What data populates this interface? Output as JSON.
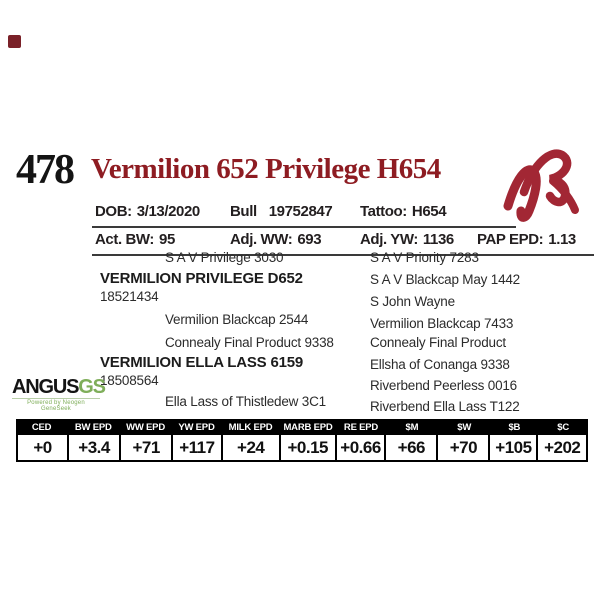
{
  "page": {
    "lot_number": "478",
    "title": "Vermilion 652 Privilege H654"
  },
  "info": {
    "row1": [
      {
        "label": "DOB:",
        "value": "3/13/2020"
      },
      {
        "label": "Bull",
        "value": "19752847"
      },
      {
        "label": "Tattoo:",
        "value": "H654"
      }
    ],
    "row2": [
      {
        "label": "Act. BW:",
        "value": "95"
      },
      {
        "label": "Adj. WW:",
        "value": "693"
      },
      {
        "label": "Adj. YW:",
        "value": "1136"
      },
      {
        "label": "PAP EPD:",
        "value": "1.13"
      }
    ]
  },
  "pedigree": {
    "left": [
      {
        "text": "S A V Privilege 3030"
      },
      {
        "text": "VERMILION PRIVILEGE D652"
      },
      {
        "text": "18521434"
      },
      {
        "text": "Vermilion Blackcap 2544"
      },
      {
        "text": "Connealy Final Product 9338"
      },
      {
        "text": "VERMILION ELLA LASS 6159"
      },
      {
        "text": "18508564"
      },
      {
        "text": "Ella Lass of Thistledew 3C1"
      }
    ],
    "right": [
      {
        "text": "S A V Priority 7283"
      },
      {
        "text": "S A V Blackcap May 1442"
      },
      {
        "text": "S John Wayne"
      },
      {
        "text": "Vermilion Blackcap 7433"
      },
      {
        "text": "Connealy Final Product"
      },
      {
        "text": "Ellsha of Conanga 9338"
      },
      {
        "text": "Riverbend Peerless 0016"
      },
      {
        "text": "Riverbend Ella Lass T122"
      }
    ]
  },
  "angus_logo": {
    "main": "ANGUS",
    "sub": "GS",
    "tagline": "Powered by Neogen GeneSeek"
  },
  "brand_logo": {
    "name": "vermilion-ranch-vr-brand"
  },
  "epd_table": {
    "columns": [
      "CED",
      "BW EPD",
      "WW EPD",
      "YW EPD",
      "MILK EPD",
      "MARB EPD",
      "RE EPD",
      "$M",
      "$W",
      "$B",
      "$C"
    ],
    "values": [
      "+0",
      "+3.4",
      "+71",
      "+117",
      "+24",
      "+0.15",
      "+0.66",
      "+66",
      "+70",
      "+105",
      "+202"
    ]
  },
  "colors": {
    "title_red": "#8e1c22",
    "brand_red": "#a22734",
    "angus_green": "#7fae5a",
    "text_black": "#231f20"
  }
}
